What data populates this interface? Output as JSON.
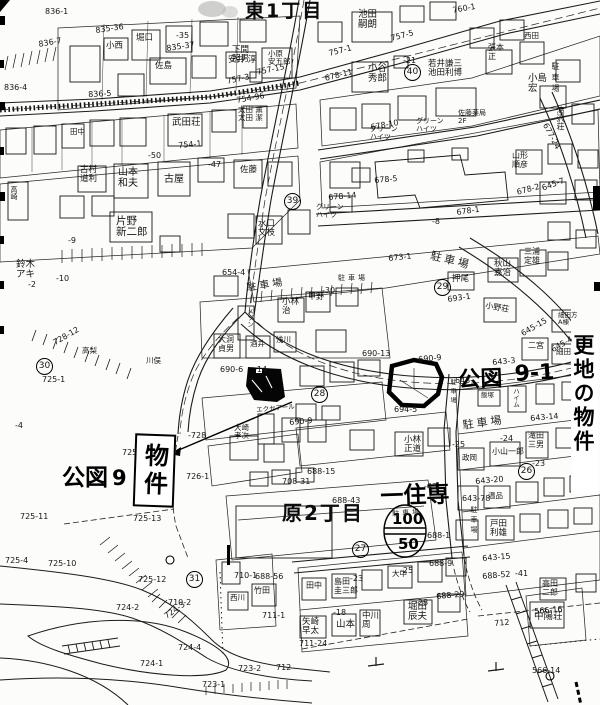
{
  "map": {
    "property_box": {
      "text": "物件"
    },
    "margin_note": {
      "text": "更地の物件"
    },
    "layers": [
      {
        "name": "district-label",
        "cls": "district",
        "items": [
          {
            "t": "東1丁目",
            "x": 245,
            "y": 1,
            "fs": 19
          },
          {
            "t": "原2丁目",
            "x": 282,
            "y": 503,
            "fs": 20
          }
        ]
      },
      {
        "name": "handwritten-note",
        "cls": "hand",
        "items": [
          {
            "t": "公図",
            "x": 62,
            "y": 466,
            "fs": 23
          },
          {
            "t": "9 -",
            "x": 112,
            "y": 467,
            "fs": 21
          },
          {
            "t": "公図",
            "x": 458,
            "y": 369,
            "fs": 22,
            "r": -2
          },
          {
            "t": "9-1",
            "x": 514,
            "y": 363,
            "fs": 22,
            "r": -3
          },
          {
            "t": "一住専",
            "x": 380,
            "y": 485,
            "fs": 23,
            "r": -2
          },
          {
            "t": "100",
            "x": 392,
            "y": 511,
            "fs": 15
          },
          {
            "t": "50",
            "x": 398,
            "y": 536,
            "fs": 15
          }
        ]
      },
      {
        "name": "parking-label",
        "cls": "park",
        "items": [
          {
            "t": "駐車場",
            "x": 551,
            "y": 62,
            "fs": 8,
            "v": 1
          },
          {
            "t": "駐車場",
            "x": 432,
            "y": 250,
            "fs": 11,
            "r": 14
          },
          {
            "t": "駐車場",
            "x": 246,
            "y": 284,
            "fs": 10,
            "r": -9
          },
          {
            "t": "駐車場",
            "x": 338,
            "y": 275,
            "fs": 7
          },
          {
            "t": "駐車場",
            "x": 462,
            "y": 420,
            "fs": 11,
            "r": -8
          },
          {
            "t": "駐車場",
            "x": 449,
            "y": 379,
            "fs": 6,
            "v": 1
          },
          {
            "t": "駐車場",
            "x": 470,
            "y": 506,
            "fs": 7,
            "v": 1
          },
          {
            "t": "駐車場",
            "x": 392,
            "y": 511,
            "fs": 7,
            "r": -4
          }
        ]
      },
      {
        "name": "circled-number",
        "cls": "circ",
        "items": [
          {
            "t": "30",
            "x": 36,
            "y": 358
          },
          {
            "t": "31",
            "x": 186,
            "y": 571
          },
          {
            "t": "39",
            "x": 284,
            "y": 193
          },
          {
            "t": "40",
            "x": 404,
            "y": 64
          },
          {
            "t": "29",
            "x": 434,
            "y": 279
          },
          {
            "t": "28",
            "x": 311,
            "y": 386
          },
          {
            "t": "27",
            "x": 352,
            "y": 541
          },
          {
            "t": "26",
            "x": 518,
            "y": 463
          }
        ]
      },
      {
        "name": "parcel-number-label",
        "cls": "pnum",
        "items": [
          {
            "t": "836-1",
            "x": 45,
            "y": 8
          },
          {
            "t": "835-36",
            "x": 95,
            "y": 27,
            "r": -8
          },
          {
            "t": "835-37",
            "x": 166,
            "y": 45,
            "r": -8
          },
          {
            "t": "-35",
            "x": 176,
            "y": 32
          },
          {
            "t": "836-7",
            "x": 38,
            "y": 41,
            "r": -10
          },
          {
            "t": "836-5",
            "x": 88,
            "y": 91,
            "r": -3
          },
          {
            "t": "836-4",
            "x": 4,
            "y": 84
          },
          {
            "t": "757-3",
            "x": 226,
            "y": 78,
            "r": -12
          },
          {
            "t": "757-15",
            "x": 256,
            "y": 69,
            "r": -12
          },
          {
            "t": "754-96",
            "x": 236,
            "y": 97,
            "r": -10
          },
          {
            "t": "754-1",
            "x": 178,
            "y": 142,
            "r": -5
          },
          {
            "t": "760-1",
            "x": 452,
            "y": 7,
            "r": -10
          },
          {
            "t": "757-5",
            "x": 390,
            "y": 35,
            "r": -14
          },
          {
            "t": "757-1",
            "x": 328,
            "y": 50,
            "r": -14
          },
          {
            "t": "678-11",
            "x": 324,
            "y": 75,
            "r": -14
          },
          {
            "t": "-21",
            "x": 403,
            "y": 57
          },
          {
            "t": "678-10",
            "x": 370,
            "y": 124,
            "r": -10
          },
          {
            "t": "677-24",
            "x": 548,
            "y": 122,
            "r": 62
          },
          {
            "t": "678-5",
            "x": 374,
            "y": 177,
            "r": -5
          },
          {
            "t": "678-1",
            "x": 456,
            "y": 209,
            "r": -8
          },
          {
            "t": "-8",
            "x": 432,
            "y": 218
          },
          {
            "t": "678-2",
            "x": 516,
            "y": 189,
            "r": -15
          },
          {
            "t": "678-14",
            "x": 328,
            "y": 194,
            "r": -5
          },
          {
            "t": "-47",
            "x": 208,
            "y": 161
          },
          {
            "t": "-50",
            "x": 148,
            "y": 152
          },
          {
            "t": "-9",
            "x": 68,
            "y": 237
          },
          {
            "t": "-10",
            "x": 56,
            "y": 275
          },
          {
            "t": "-2",
            "x": 28,
            "y": 281
          },
          {
            "t": "673-1",
            "x": 388,
            "y": 255,
            "r": -6
          },
          {
            "t": "645-7",
            "x": 541,
            "y": 185,
            "r": -20
          },
          {
            "t": "643-3",
            "x": 492,
            "y": 359,
            "r": -5
          },
          {
            "t": "643-",
            "x": 455,
            "y": 377
          },
          {
            "t": "690-9",
            "x": 418,
            "y": 356,
            "r": -5
          },
          {
            "t": "690-13",
            "x": 362,
            "y": 350
          },
          {
            "t": "690-6",
            "x": 220,
            "y": 366
          },
          {
            "t": "-14",
            "x": 254,
            "y": 366
          },
          {
            "t": "654-4",
            "x": 222,
            "y": 269
          },
          {
            "t": "-30",
            "x": 322,
            "y": 287
          },
          {
            "t": "688-15",
            "x": 307,
            "y": 468
          },
          {
            "t": "688-43",
            "x": 332,
            "y": 497
          },
          {
            "t": "-43",
            "x": 424,
            "y": 483
          },
          {
            "t": "688-1",
            "x": 427,
            "y": 532
          },
          {
            "t": "688-9",
            "x": 429,
            "y": 560
          },
          {
            "t": "-25",
            "x": 400,
            "y": 567
          },
          {
            "t": "688-56",
            "x": 255,
            "y": 573
          },
          {
            "t": "708-31",
            "x": 282,
            "y": 478
          },
          {
            "t": "710-1",
            "x": 234,
            "y": 572
          },
          {
            "t": "710-2",
            "x": 168,
            "y": 599
          },
          {
            "t": "711-1",
            "x": 262,
            "y": 612
          },
          {
            "t": "712",
            "x": 276,
            "y": 664
          },
          {
            "t": "712",
            "x": 494,
            "y": 620,
            "r": -5
          },
          {
            "t": "723-2",
            "x": 238,
            "y": 665
          },
          {
            "t": "723-1",
            "x": 202,
            "y": 681
          },
          {
            "t": "724-1",
            "x": 140,
            "y": 660
          },
          {
            "t": "724-2",
            "x": 116,
            "y": 604
          },
          {
            "t": "724-3",
            "x": 163,
            "y": 614,
            "r": -35
          },
          {
            "t": "724-4",
            "x": 178,
            "y": 644
          },
          {
            "t": "725-10",
            "x": 48,
            "y": 560
          },
          {
            "t": "725-11",
            "x": 20,
            "y": 513
          },
          {
            "t": "725-12",
            "x": 138,
            "y": 576
          },
          {
            "t": "725-13",
            "x": 133,
            "y": 515
          },
          {
            "t": "725-4",
            "x": 5,
            "y": 557
          },
          {
            "t": "725-1",
            "x": 42,
            "y": 376
          },
          {
            "t": "725-",
            "x": 122,
            "y": 449
          },
          {
            "t": "-728",
            "x": 188,
            "y": 432
          },
          {
            "t": "726-1",
            "x": 186,
            "y": 473
          },
          {
            "t": "728-12",
            "x": 52,
            "y": 340,
            "r": -30
          },
          {
            "t": "-4",
            "x": 15,
            "y": 422
          },
          {
            "t": "694-5",
            "x": 394,
            "y": 406
          },
          {
            "t": "643-14",
            "x": 530,
            "y": 415,
            "r": -5
          },
          {
            "t": "-23",
            "x": 532,
            "y": 460
          },
          {
            "t": "-24",
            "x": 500,
            "y": 435
          },
          {
            "t": "-25",
            "x": 452,
            "y": 441
          },
          {
            "t": "643-20",
            "x": 475,
            "y": 478,
            "r": -5
          },
          {
            "t": "643-78",
            "x": 462,
            "y": 495
          },
          {
            "t": "643-15",
            "x": 482,
            "y": 555,
            "r": -5
          },
          {
            "t": "-41",
            "x": 515,
            "y": 570
          },
          {
            "t": "688-29",
            "x": 436,
            "y": 593,
            "r": -5
          },
          {
            "t": "688-52",
            "x": 482,
            "y": 573,
            "r": -5
          },
          {
            "t": "-23",
            "x": 350,
            "y": 575
          },
          {
            "t": "-18",
            "x": 333,
            "y": 609
          },
          {
            "t": "-28",
            "x": 415,
            "y": 599
          },
          {
            "t": "711-24",
            "x": 299,
            "y": 640
          },
          {
            "t": "566-16",
            "x": 534,
            "y": 608,
            "r": -5
          },
          {
            "t": "566-14",
            "x": 532,
            "y": 667
          },
          {
            "t": "693-1",
            "x": 447,
            "y": 296,
            "r": -8
          },
          {
            "t": "645-15",
            "x": 520,
            "y": 331,
            "r": -30
          },
          {
            "t": "645-4",
            "x": 550,
            "y": 347,
            "r": -30
          },
          {
            "t": "690-9",
            "x": 289,
            "y": 419,
            "r": -5
          }
        ]
      },
      {
        "name": "name-label",
        "cls": "name",
        "items": [
          {
            "t": "小西",
            "x": 106,
            "y": 42
          },
          {
            "t": "堀口",
            "x": 136,
            "y": 34
          },
          {
            "t": "佐島",
            "x": 155,
            "y": 62
          },
          {
            "t": "安井 淳",
            "x": 228,
            "y": 56
          },
          {
            "t": "下間\n照男",
            "x": 232,
            "y": 46
          },
          {
            "t": "小原\n安五郎",
            "x": 268,
            "y": 50,
            "fs": 7.5
          },
          {
            "t": "武田荘",
            "x": 172,
            "y": 118,
            "fs": 9.5
          },
          {
            "t": "太田 薫\n太田 潔",
            "x": 238,
            "y": 106,
            "fs": 7.5
          },
          {
            "t": "田中",
            "x": 70,
            "y": 128,
            "fs": 7.5
          },
          {
            "t": "池田\n嗣朗",
            "x": 358,
            "y": 10,
            "fs": 9.5
          },
          {
            "t": "小谷\n秀郎",
            "x": 368,
            "y": 64,
            "fs": 9.5
          },
          {
            "t": "若井謙三\n池田利博",
            "x": 428,
            "y": 60
          },
          {
            "t": "張本\n正",
            "x": 488,
            "y": 44,
            "fs": 8
          },
          {
            "t": "西田",
            "x": 524,
            "y": 32,
            "fs": 7.5
          },
          {
            "t": "小島\n宏",
            "x": 528,
            "y": 74,
            "fs": 9.5
          },
          {
            "t": "滝沢荘",
            "x": 556,
            "y": 106,
            "fs": 8,
            "v": 1
          },
          {
            "t": "グリーン\nハイツ",
            "x": 370,
            "y": 126,
            "fs": 7
          },
          {
            "t": "グリーン\nハイツ",
            "x": 416,
            "y": 118,
            "fs": 7
          },
          {
            "t": "グリーン\nハイツ",
            "x": 316,
            "y": 204,
            "fs": 7
          },
          {
            "t": "佐藤薬局\n2F",
            "x": 458,
            "y": 110,
            "fs": 7
          },
          {
            "t": "古村\n道利",
            "x": 80,
            "y": 166
          },
          {
            "t": "山本\n和夫",
            "x": 118,
            "y": 168,
            "fs": 10
          },
          {
            "t": "古屋",
            "x": 164,
            "y": 175,
            "fs": 10
          },
          {
            "t": "佐藤",
            "x": 240,
            "y": 166
          },
          {
            "t": "片野\n新二郎",
            "x": 116,
            "y": 216,
            "fs": 10.5
          },
          {
            "t": "鈴木\nアキ",
            "x": 16,
            "y": 260,
            "fs": 9.5
          },
          {
            "t": "水口\n文枝",
            "x": 258,
            "y": 220
          },
          {
            "t": "高崎",
            "x": 10,
            "y": 186,
            "fs": 7,
            "v": 1
          },
          {
            "t": "山形\n順彦",
            "x": 512,
            "y": 152,
            "fs": 8
          },
          {
            "t": "秋山\n嘉治",
            "x": 494,
            "y": 260
          },
          {
            "t": "三浦\n定雄",
            "x": 524,
            "y": 248,
            "fs": 8
          },
          {
            "t": "押尾",
            "x": 452,
            "y": 275
          },
          {
            "t": "小野荘",
            "x": 486,
            "y": 302,
            "fs": 8,
            "r": 10
          },
          {
            "t": "二宮",
            "x": 528,
            "y": 342,
            "fs": 8
          },
          {
            "t": "細田方\nA棟",
            "x": 558,
            "y": 312,
            "fs": 6.5
          },
          {
            "t": "細田",
            "x": 556,
            "y": 348,
            "fs": 7.5
          },
          {
            "t": "小林\n治",
            "x": 282,
            "y": 298
          },
          {
            "t": "甲野",
            "x": 308,
            "y": 293,
            "fs": 8
          },
          {
            "t": "大洞\n貞男",
            "x": 218,
            "y": 336,
            "fs": 8
          },
          {
            "t": "酒井",
            "x": 250,
            "y": 340,
            "fs": 7.5
          },
          {
            "t": "浅川",
            "x": 276,
            "y": 336,
            "fs": 7.5
          },
          {
            "t": "メゾン",
            "x": 246,
            "y": 308,
            "fs": 6.5,
            "v": 1
          },
          {
            "t": "川俣",
            "x": 146,
            "y": 357,
            "fs": 7.5
          },
          {
            "t": "高梨",
            "x": 82,
            "y": 347,
            "fs": 7.5
          },
          {
            "t": "小林\n正道",
            "x": 404,
            "y": 436
          },
          {
            "t": "滝田\n三男",
            "x": 528,
            "y": 432,
            "fs": 8
          },
          {
            "t": "小山一郎",
            "x": 492,
            "y": 448,
            "fs": 8
          },
          {
            "t": "政岡",
            "x": 462,
            "y": 454,
            "fs": 7.5
          },
          {
            "t": "戸田\n利雄",
            "x": 490,
            "y": 520
          },
          {
            "t": "大崎\n孝次",
            "x": 234,
            "y": 424,
            "fs": 7.5
          },
          {
            "t": "エクセアール",
            "x": 256,
            "y": 407,
            "fs": 6.5,
            "r": -5
          },
          {
            "t": "飯塚",
            "x": 481,
            "y": 392,
            "fs": 6.5
          },
          {
            "t": "ハイム",
            "x": 512,
            "y": 388,
            "fs": 6.5,
            "v": 1
          },
          {
            "t": "島田\n圭三郎",
            "x": 334,
            "y": 578,
            "fs": 8
          },
          {
            "t": "田中",
            "x": 306,
            "y": 582,
            "fs": 8
          },
          {
            "t": "矢崎\n早太",
            "x": 302,
            "y": 618
          },
          {
            "t": "山本",
            "x": 336,
            "y": 620,
            "fs": 9.5
          },
          {
            "t": "中川\n周",
            "x": 362,
            "y": 612
          },
          {
            "t": "堀田\n辰夫",
            "x": 408,
            "y": 602,
            "fs": 9.5
          },
          {
            "t": "大中",
            "x": 392,
            "y": 570,
            "fs": 7.5
          },
          {
            "t": "高田\n二郎",
            "x": 542,
            "y": 580,
            "fs": 8
          },
          {
            "t": "中陽荘",
            "x": 534,
            "y": 612,
            "fs": 9.5
          },
          {
            "t": "竹田",
            "x": 254,
            "y": 587,
            "fs": 8
          },
          {
            "t": "西川",
            "x": 230,
            "y": 594,
            "fs": 7.5
          },
          {
            "t": "温品",
            "x": 488,
            "y": 492,
            "fs": 7.5
          }
        ]
      }
    ]
  }
}
